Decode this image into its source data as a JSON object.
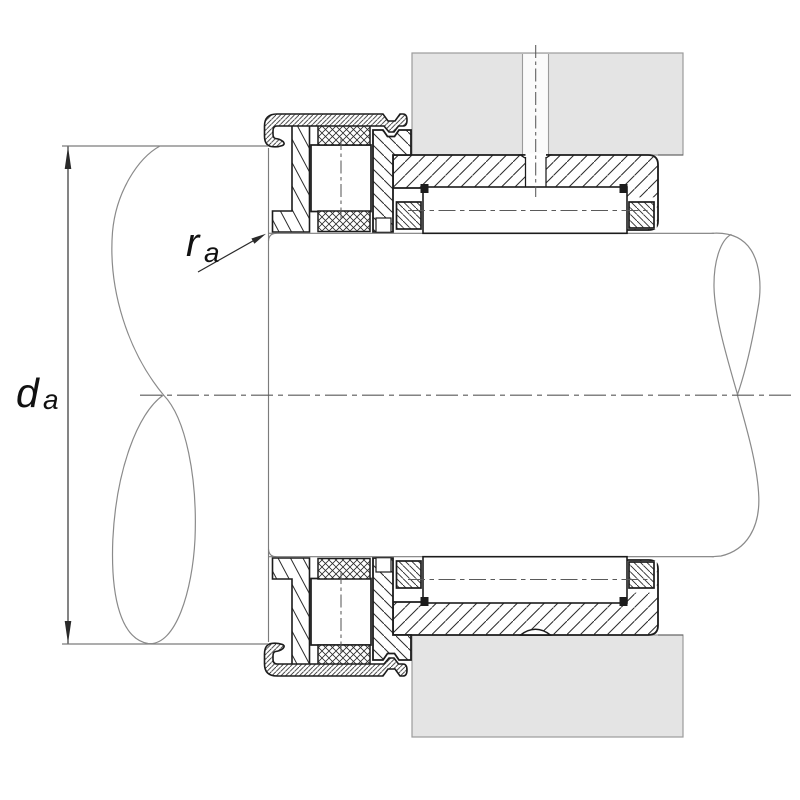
{
  "drawing": {
    "type": "bearing-mounting-cross-section",
    "description": "Sectional mounting drawing of a combined needle roller / axial cylindrical roller bearing with end cap, fitted in a housing bore on a stepped shaft, showing abutment dimensions",
    "dimension_labels": {
      "shaft_abutment_diameter": {
        "symbol": "d",
        "subscript": "a"
      },
      "max_fillet_radius": {
        "symbol": "r",
        "subscript": "a"
      }
    },
    "components": [
      "housing",
      "lubrication-hole",
      "outer-ring-sleeve",
      "abutment-flange",
      "needle-rollers",
      "needle-cage-end-rings",
      "axial-roller-and-cage-assembly",
      "shaft-locating-washer",
      "drawn-end-cap",
      "stepped-shaft",
      "break-lines",
      "centerlines"
    ],
    "colors": {
      "background": "#ffffff",
      "housing_fill": "#e4e4e4",
      "outline": "#1c1c1c",
      "hatch": "#2a2a2a",
      "break_line": "#8a8a8a",
      "centerline": "#5a5a5a",
      "housing_line": "#9b9b9b",
      "shaft_line": "#7c7c7c",
      "dimension": "#2a2a2a",
      "label": "#111111",
      "slot_fill": "#fbfbfb"
    }
  }
}
